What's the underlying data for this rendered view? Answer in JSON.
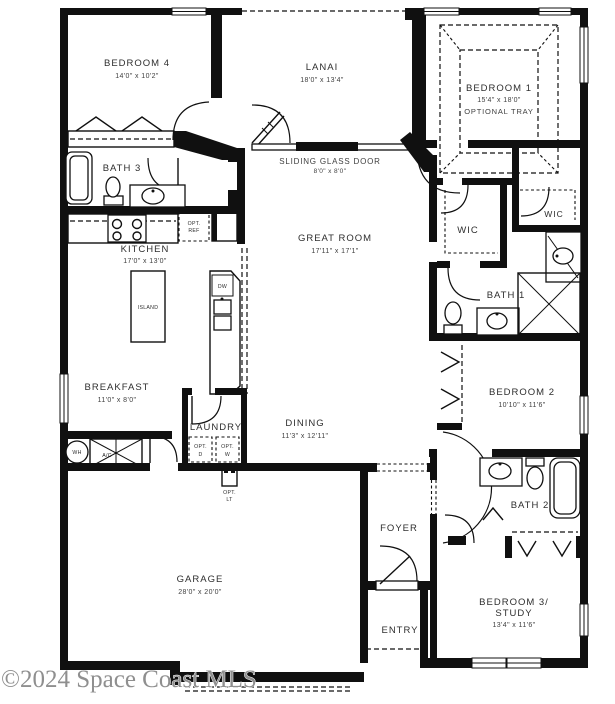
{
  "watermark": "©2024 Space Coast MLS",
  "colors": {
    "wall": "#101010",
    "background": "#ffffff",
    "watermark": "#8f8f8f"
  },
  "rooms": {
    "bedroom4": {
      "name": "BEDROOM 4",
      "dims": "14'0\" x 10'2\""
    },
    "lanai": {
      "name": "LANAI",
      "dims": "18'0\" x 13'4\""
    },
    "bedroom1": {
      "name": "BEDROOM 1",
      "dims": "15'4\" x 18'0\"",
      "note": "OPTIONAL TRAY"
    },
    "bath3": {
      "name": "BATH 3"
    },
    "sliding_glass_door": {
      "name": "SLIDING GLASS DOOR",
      "dims": "8'0\" x 8'0\""
    },
    "kitchen": {
      "name": "KITCHEN",
      "dims": "17'0\" x 13'0\""
    },
    "great_room": {
      "name": "GREAT ROOM",
      "dims": "17'11\" x 17'1\""
    },
    "wic_left": {
      "name": "WIC"
    },
    "wic_right": {
      "name": "WIC"
    },
    "bath1": {
      "name": "BATH 1"
    },
    "breakfast": {
      "name": "BREAKFAST",
      "dims": "11'0\" x 8'0\""
    },
    "bedroom2": {
      "name": "BEDROOM 2",
      "dims": "10'10\" x 11'6\""
    },
    "laundry": {
      "name": "LAUNDRY"
    },
    "dining": {
      "name": "DINING",
      "dims": "11'3\" x 12'11\""
    },
    "foyer": {
      "name": "FOYER"
    },
    "bath2": {
      "name": "BATH 2"
    },
    "garage": {
      "name": "GARAGE",
      "dims": "28'0\" x 20'0\""
    },
    "entry": {
      "name": "ENTRY"
    },
    "bedroom3": {
      "name_line1": "BEDROOM 3/",
      "name_line2": "STUDY",
      "dims": "13'4\" x 11'6\""
    }
  },
  "fixtures": {
    "opt_ref": {
      "line1": "OPT.",
      "line2": "REF"
    },
    "island": "ISLAND",
    "dw": "DW",
    "opt_d": {
      "line1": "OPT.",
      "line2": "D"
    },
    "opt_w": {
      "line1": "OPT.",
      "line2": "W"
    },
    "opt_lt": {
      "line1": "OPT.",
      "line2": "LT"
    },
    "ac": "A/C",
    "wh": "WH"
  }
}
